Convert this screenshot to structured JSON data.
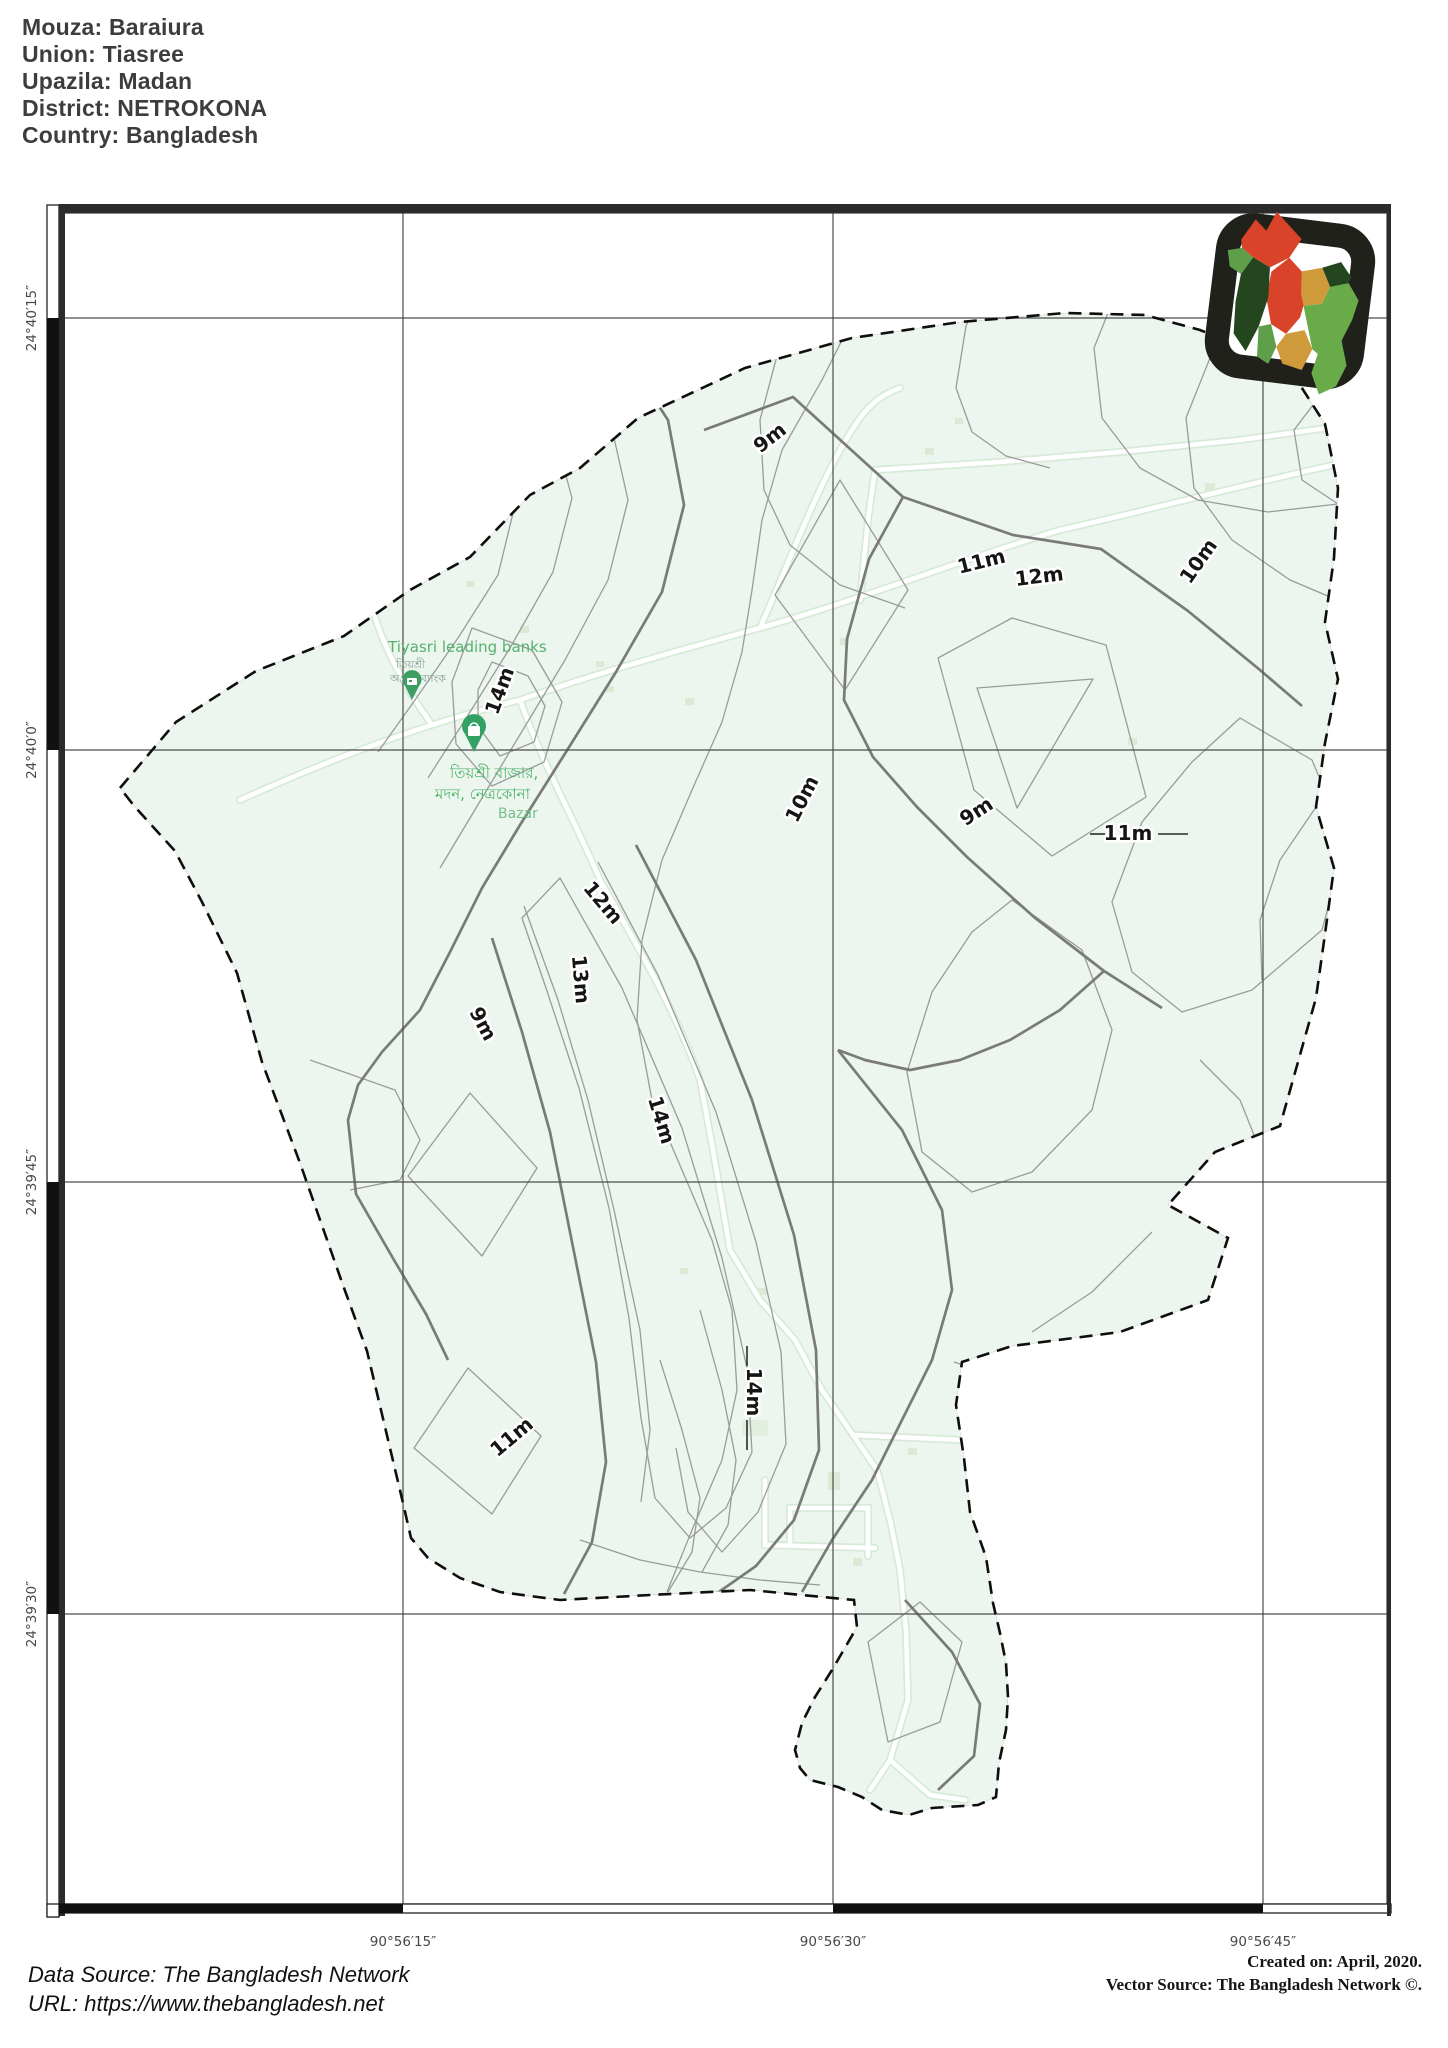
{
  "header": {
    "lines": [
      "Mouza: Baraiura",
      "Union: Tiasree",
      "Upazila: Madan",
      "District: NETROKONA",
      "Country: Bangladesh"
    ]
  },
  "map": {
    "latitude_labels": [
      {
        "text": "24°40′15″",
        "y": 318
      },
      {
        "text": "24°40′0″",
        "y": 750
      },
      {
        "text": "24°39′45″",
        "y": 1182
      },
      {
        "text": "24°39′30″",
        "y": 1614
      }
    ],
    "longitude_labels": [
      {
        "text": "90°56′15″",
        "x": 403
      },
      {
        "text": "90°56′30″",
        "x": 833
      },
      {
        "text": "90°56′45″",
        "x": 1263
      }
    ],
    "contour_labels": [
      {
        "text": "9m",
        "x": 774,
        "y": 443,
        "rot": -38
      },
      {
        "text": "11m",
        "x": 983,
        "y": 568,
        "rot": -14
      },
      {
        "text": "12m",
        "x": 1040,
        "y": 583,
        "rot": -7
      },
      {
        "text": "10m",
        "x": 1204,
        "y": 565,
        "rot": -55
      },
      {
        "text": "14m",
        "x": 506,
        "y": 693,
        "rot": -70
      },
      {
        "text": "10m",
        "x": 808,
        "y": 802,
        "rot": -63
      },
      {
        "text": "9m",
        "x": 980,
        "y": 817,
        "rot": -33
      },
      {
        "text": "11m",
        "x": 1128,
        "y": 840,
        "rot": 0
      },
      {
        "text": "12m",
        "x": 598,
        "y": 907,
        "rot": 50
      },
      {
        "text": "13m",
        "x": 574,
        "y": 980,
        "rot": 85
      },
      {
        "text": "9m",
        "x": 477,
        "y": 1027,
        "rot": 62
      },
      {
        "text": "14m",
        "x": 655,
        "y": 1122,
        "rot": 73
      },
      {
        "text": "14m",
        "x": 747,
        "y": 1392,
        "rot": 90
      },
      {
        "text": "11m",
        "x": 516,
        "y": 1442,
        "rot": -40
      }
    ],
    "place_labels": {
      "bank_name": "Tiyasri leading banks",
      "bank_bn_line1": "তিয়শ্রী",
      "bank_bn_line2": "অগ্রণী ব্যাংক",
      "bazar_bn_line1": "তিয়শ্রী বাজার,",
      "bazar_bn_line2": "মদন, নেত্রকোনা",
      "bazar_en": "Bazar"
    }
  },
  "footer": {
    "data_source": "Data Source: The Bangladesh Network",
    "url": "URL: https://www.thebangladesh.net",
    "created_on": "Created on: April, 2020.",
    "vector_source": "Vector Source: The Bangladesh Network ©."
  },
  "colors": {
    "map_fill": "#ecf5ee",
    "contour_thin": "#9b9b9b",
    "contour_index": "#7a7a7a",
    "boundary": "#0e0e0e",
    "grid": "#4d4d4d",
    "place_green": "#4db36b",
    "logo_red": "#d8432a",
    "logo_dark_green": "#24461f",
    "logo_mid_green": "#5f9e4b",
    "logo_light_green": "#69ab49",
    "logo_mustard": "#cf9b3a",
    "frame": "#2b2b2b"
  }
}
